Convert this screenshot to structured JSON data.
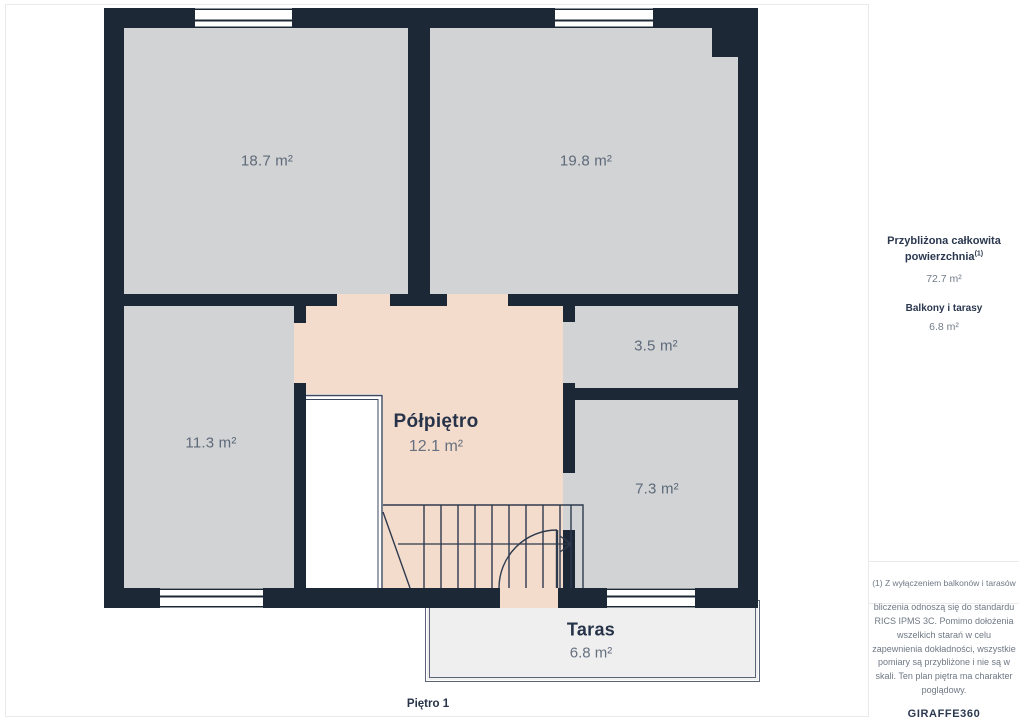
{
  "plan": {
    "floor_label": "Piętro 1",
    "rooms": [
      {
        "id": "room-top-left",
        "area": "18.7 m²"
      },
      {
        "id": "room-top-right",
        "area": "19.8 m²"
      },
      {
        "id": "room-left",
        "area": "11.3 m²"
      },
      {
        "id": "room-small",
        "area": "3.5 m²"
      },
      {
        "id": "room-right-bottom",
        "area": "7.3 m²"
      }
    ],
    "halffloor": {
      "name": "Półpiętro",
      "area": "12.1 m²"
    },
    "terrace": {
      "name": "Taras",
      "area": "6.8 m²"
    }
  },
  "sidebar": {
    "total_label": "Przybliżona całkowita powierzchnia",
    "total_superscript": "(1)",
    "total_value": "72.7 m²",
    "balcony_label": "Balkony i tarasy",
    "balcony_value": "6.8 m²",
    "footnote": "(1) Z wyłączeniem balkonów i tarasów",
    "disclaimer": "bliczenia odnoszą się do standardu RICS IPMS 3C. Pomimo dołożenia wszelkich starań w celu zapewnienia dokładności, wszystkie pomiary są przybliżone i nie są w skali. Ten plan piętra ma charakter poglądowy.",
    "logo_primary": "GIRAFFE",
    "logo_secondary": "360"
  },
  "colors": {
    "wall": "#1d2836",
    "room_floor": "#d2d3d4",
    "halffloor_floor": "#f4dccd",
    "terrace_floor": "#efeff0",
    "line": "#2e3a4e",
    "accent_text": "#273349"
  }
}
